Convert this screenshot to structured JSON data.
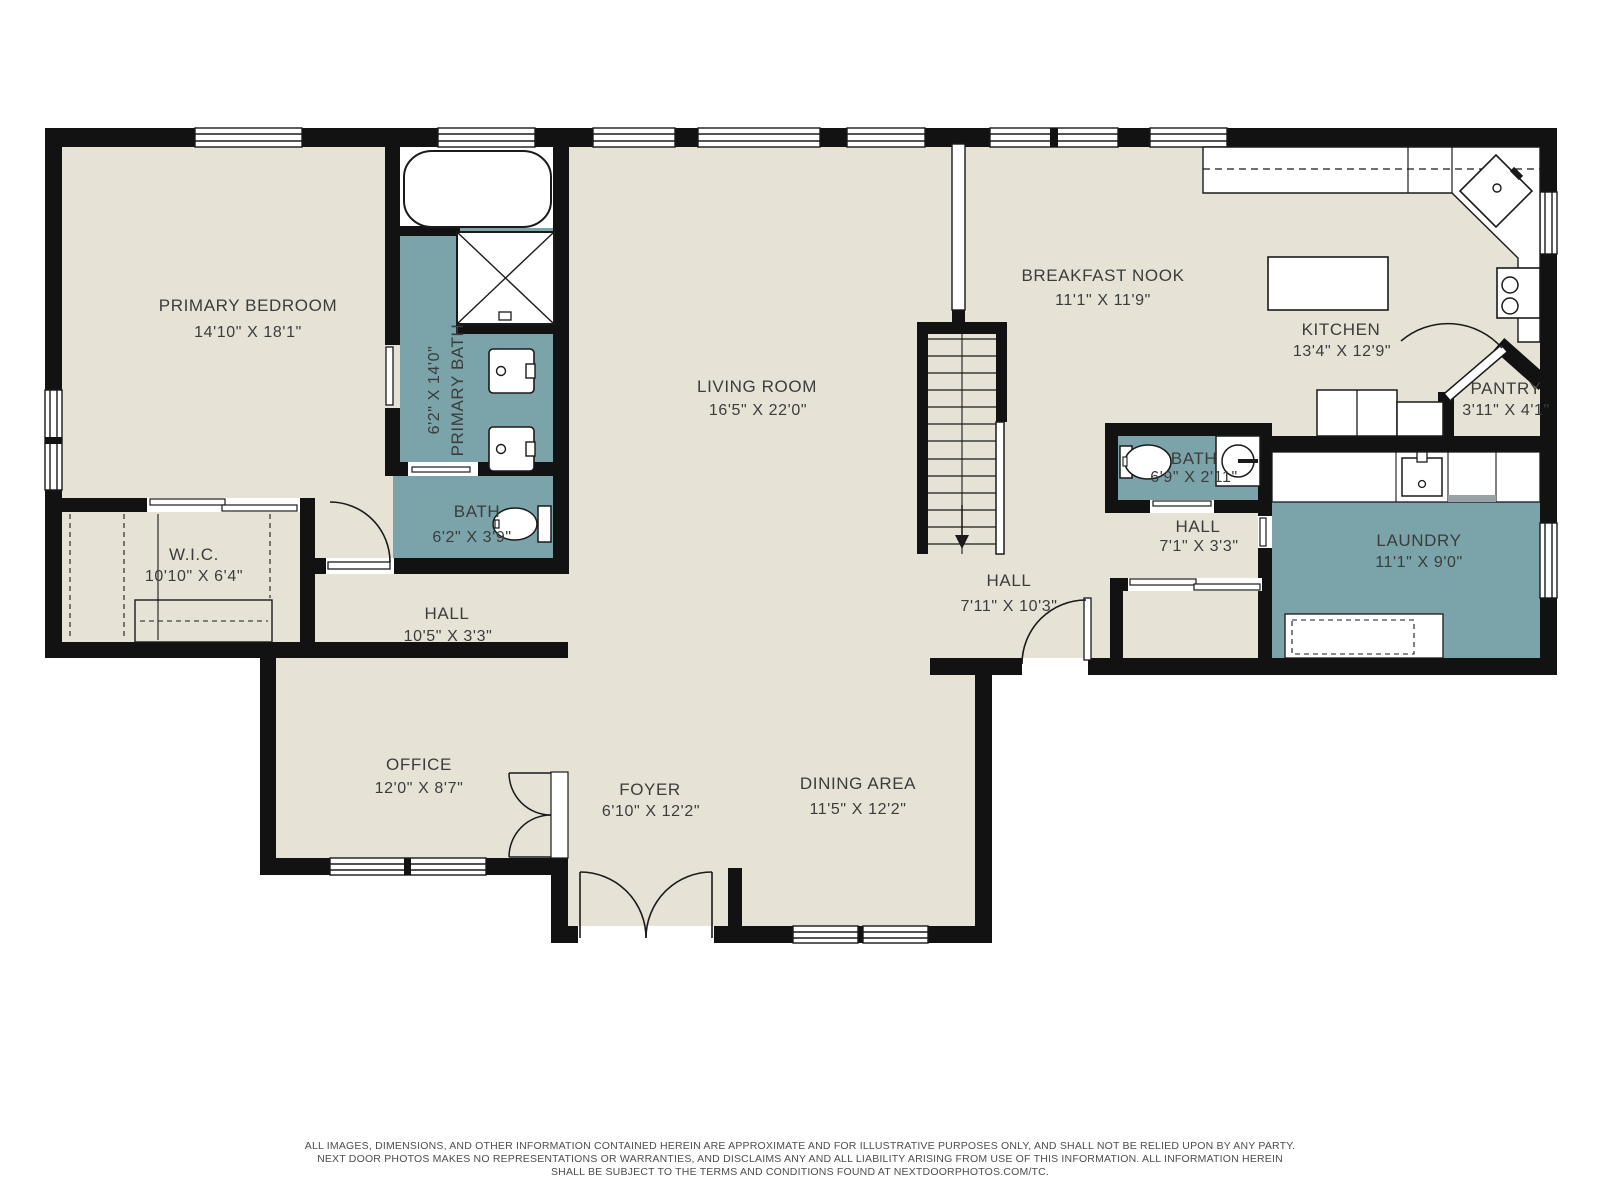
{
  "colors": {
    "floor_beige": "#e6e3d6",
    "accent_teal": "#7aa3aa",
    "wall_black": "#121212",
    "label_gray": "#3c3c3c",
    "fixture_white": "#ffffff"
  },
  "rooms": [
    {
      "id": "primary-bedroom",
      "name": "PRIMARY BEDROOM",
      "dims": "14'10\" X 18'1\""
    },
    {
      "id": "primary-bath",
      "name": "PRIMARY BATH",
      "dims": "6'2\" X 14'0\""
    },
    {
      "id": "bath-main",
      "name": "BATH",
      "dims": "6'2\" X 3'9\""
    },
    {
      "id": "wic",
      "name": "W.I.C.",
      "dims": "10'10\" X 6'4\""
    },
    {
      "id": "hall-left",
      "name": "HALL",
      "dims": "10'5\" X 3'3\""
    },
    {
      "id": "living-room",
      "name": "LIVING ROOM",
      "dims": "16'5\" X 22'0\""
    },
    {
      "id": "office",
      "name": "OFFICE",
      "dims": "12'0\" X 8'7\""
    },
    {
      "id": "foyer",
      "name": "FOYER",
      "dims": "6'10\" X 12'2\""
    },
    {
      "id": "dining-area",
      "name": "DINING AREA",
      "dims": "11'5\" X 12'2\""
    },
    {
      "id": "breakfast-nook",
      "name": "BREAKFAST NOOK",
      "dims": "11'1\" X 11'9\""
    },
    {
      "id": "kitchen",
      "name": "KITCHEN",
      "dims": "13'4\" X 12'9\""
    },
    {
      "id": "pantry",
      "name": "PANTRY",
      "dims": "3'11\" X 4'1\""
    },
    {
      "id": "bath-right",
      "name": "BATH",
      "dims": "6'9\" X 2'11\""
    },
    {
      "id": "hall-small",
      "name": "HALL",
      "dims": "7'1\" X 3'3\""
    },
    {
      "id": "hall-big",
      "name": "HALL",
      "dims": "7'11\" X 10'3\""
    },
    {
      "id": "laundry",
      "name": "LAUNDRY",
      "dims": "11'1\" X 9'0\""
    }
  ],
  "disclaimer": {
    "line1": "ALL IMAGES, DIMENSIONS, AND OTHER INFORMATION CONTAINED HEREIN ARE APPROXIMATE AND FOR ILLUSTRATIVE PURPOSES ONLY, AND SHALL NOT BE RELIED UPON BY ANY PARTY.",
    "line2": "NEXT DOOR PHOTOS MAKES NO REPRESENTATIONS OR WARRANTIES, AND DISCLAIMS ANY AND ALL LIABILITY ARISING FROM USE OF THIS INFORMATION. ALL INFORMATION HEREIN",
    "line3": "SHALL BE SUBJECT TO THE TERMS AND CONDITIONS FOUND AT NEXTDOORPHOTOS.COM/TC."
  }
}
